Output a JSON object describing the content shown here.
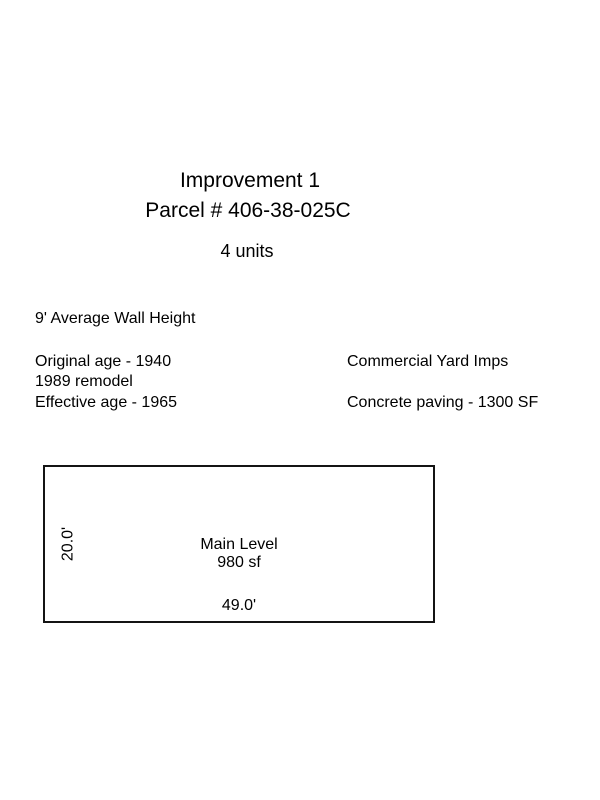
{
  "page": {
    "background_color": "#ffffff",
    "text_color": "#000000"
  },
  "header": {
    "title": "Improvement 1",
    "parcel": "Parcel # 406-38-025C",
    "units": "4 units"
  },
  "details": {
    "wall_height": "9' Average Wall Height",
    "left_column": [
      "Original age - 1940",
      "1989 remodel",
      "Effective age - 1965"
    ],
    "right_column": [
      "Commercial Yard Imps",
      "Concrete paving - 1300 SF"
    ]
  },
  "sketch": {
    "label": "Main Level",
    "area": "980 sf",
    "width_dim": "49.0'",
    "height_dim": "20.0'",
    "border_color": "#141414"
  }
}
